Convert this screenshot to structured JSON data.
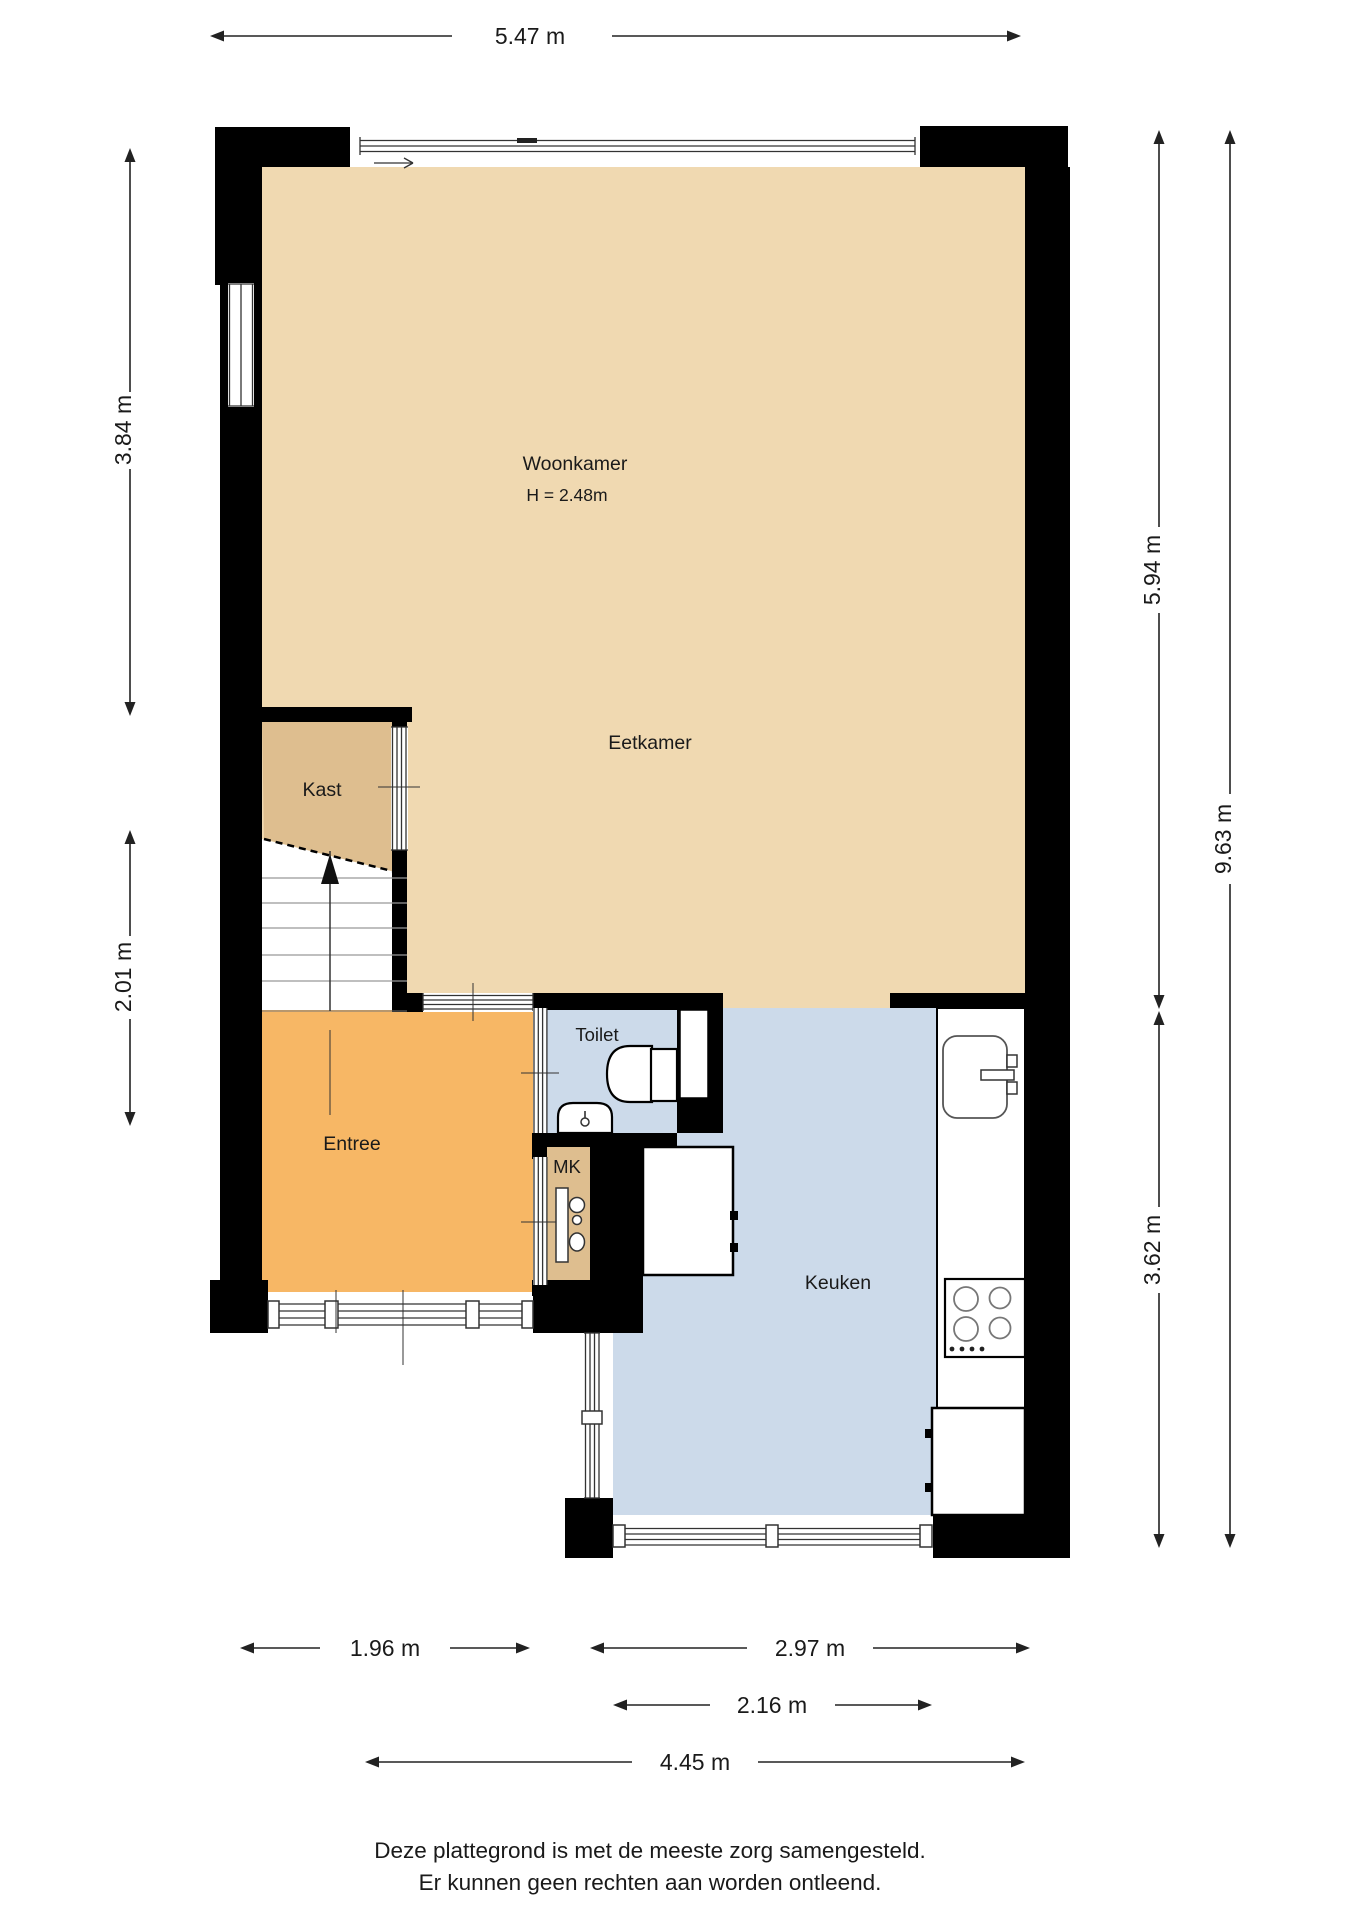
{
  "plan_title": "Begane grond plattegrond",
  "rooms": {
    "woonkamer": {
      "label": "Woonkamer",
      "ceiling_height": "H = 2.48m"
    },
    "eetkamer": {
      "label": "Eetkamer"
    },
    "kast": {
      "label": "Kast"
    },
    "entree": {
      "label": "Entree"
    },
    "toilet": {
      "label": "Toilet"
    },
    "mk": {
      "label": "MK"
    },
    "keuken": {
      "label": "Keuken"
    }
  },
  "dimensions": {
    "top_width": "5.47 m",
    "left_upper": "3.84 m",
    "left_lower": "2.01 m",
    "right_upper": "5.94 m",
    "right_lower": "3.62 m",
    "right_total": "9.63 m",
    "bottom_entree": "1.96 m",
    "bottom_keuken": "2.97 m",
    "bottom_keuken_window": "2.16 m",
    "bottom_total": "4.45 m"
  },
  "footer": {
    "line1": "Deze plattegrond is met de meeste zorg samengesteld.",
    "line2": "Er kunnen geen rechten aan worden ontleend."
  },
  "colors": {
    "living_floor": "#f0d9b1",
    "closet_floor": "#debe8f",
    "entry_floor": "#f7b765",
    "wet_floor": "#ccdaea",
    "wall": "#000000",
    "dimension_text": "#1a1a1a",
    "background": "#ffffff"
  }
}
